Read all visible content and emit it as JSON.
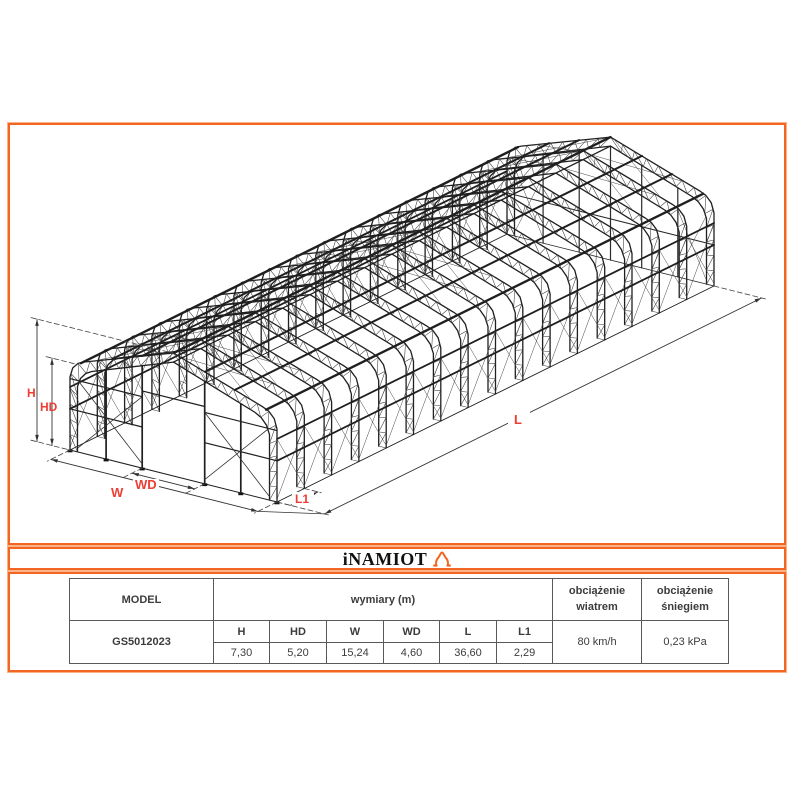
{
  "colors": {
    "accent_orange": "#f26522",
    "label_red": "#ee3d33",
    "structure_ink": "#1f1f1f",
    "table_border": "#595959"
  },
  "logo": {
    "text": "iNAMIOT",
    "icon": "tent-house-icon"
  },
  "drawing": {
    "type": "isometric-steel-truss-hangar",
    "frame_count": 17,
    "dimension_labels": [
      "H",
      "HD",
      "W",
      "WD",
      "L",
      "L1"
    ]
  },
  "table": {
    "model_header": "MODEL",
    "dims_header": "wymiary (m)",
    "wind_header": "obciążenie wiatrem",
    "snow_header": "obciążenie śniegiem",
    "model_value": "GS5012023",
    "dim_labels": [
      "H",
      "HD",
      "W",
      "WD",
      "L",
      "L1"
    ],
    "dim_values": [
      "7,30",
      "5,20",
      "15,24",
      "4,60",
      "36,60",
      "2,29"
    ],
    "wind_value": "80 km/h",
    "snow_value": "0,23 kPa"
  }
}
